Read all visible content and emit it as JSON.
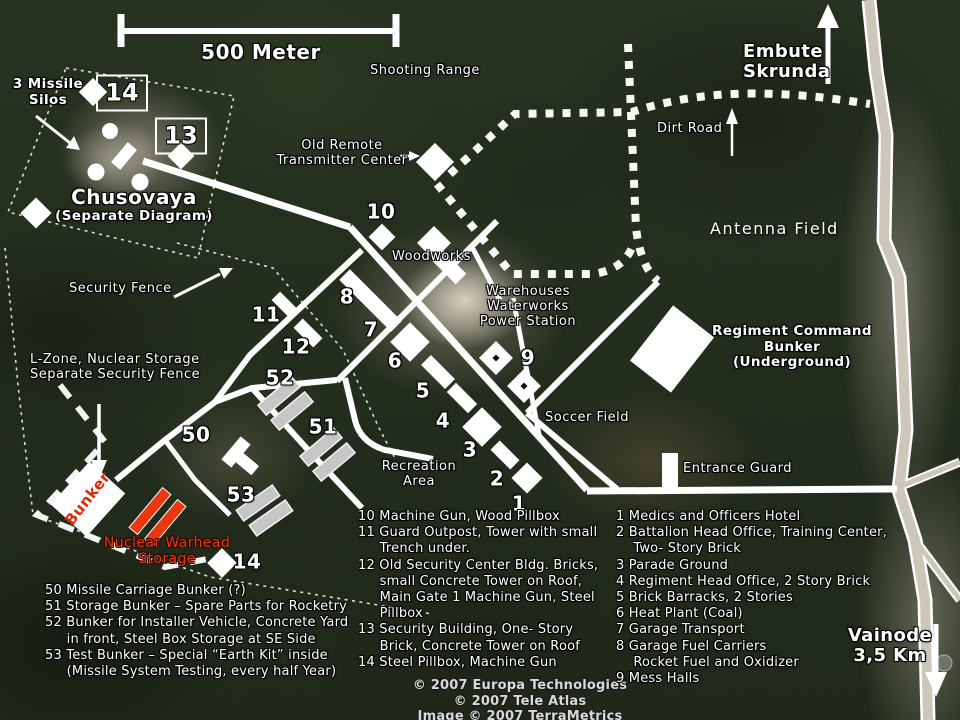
{
  "title": "Annotated satellite map of missile base",
  "colors": {
    "label_text": "#ffffff",
    "warning_text": "#e8380f",
    "road": "#ffffff",
    "highway_fill": "#cdc7b9",
    "bunker_gray": "#c6c6c6",
    "terrain": "#232d1d"
  },
  "scale_bar": {
    "label": "500 Meter"
  },
  "map_labels": [
    {
      "name": "scale-label",
      "text": "500 Meter",
      "x": 261,
      "y": 41,
      "cls": "t-bold20",
      "anchor": "center"
    },
    {
      "name": "label-shooting-range",
      "text": "Shooting Range",
      "x": 370,
      "y": 64,
      "cls": "t-reg",
      "anchor": "left"
    },
    {
      "name": "label-embute-skrunda",
      "text": "Embute\nSkrunda",
      "x": 743,
      "y": 42,
      "cls": "t-bold18",
      "anchor": "left"
    },
    {
      "name": "label-dirt-road",
      "text": "Dirt Road",
      "x": 657,
      "y": 122,
      "cls": "t-reg",
      "anchor": "left"
    },
    {
      "name": "label-antenna-field",
      "text": "Antenna Field",
      "x": 710,
      "y": 220,
      "cls": "t-reg17",
      "anchor": "left"
    },
    {
      "name": "label-old-remote-transmitter",
      "text": "Old Remote\nTransmitter Center",
      "x": 342,
      "y": 139,
      "cls": "t-reg",
      "anchor": "center"
    },
    {
      "name": "label-chusovaya",
      "text": "Chusovaya",
      "x": 134,
      "y": 186,
      "cls": "t-bold20",
      "anchor": "center"
    },
    {
      "name": "label-chusovaya-sub",
      "text": "(Separate Diagram)",
      "x": 134,
      "y": 209,
      "cls": "t-bold14",
      "anchor": "center"
    },
    {
      "name": "label-missile-silos",
      "text": "3 Missile\nSilos",
      "x": 48,
      "y": 77,
      "cls": "t-bold14",
      "anchor": "center"
    },
    {
      "name": "label-security-fence",
      "text": "Security Fence",
      "x": 69,
      "y": 282,
      "cls": "t-reg",
      "anchor": "left"
    },
    {
      "name": "label-l-zone",
      "text": "L-Zone, Nuclear Storage\nSeparate Security Fence",
      "x": 30,
      "y": 353,
      "cls": "t-reg",
      "anchor": "left"
    },
    {
      "name": "label-woodworks",
      "text": "Woodworks",
      "x": 392,
      "y": 250,
      "cls": "t-reg",
      "anchor": "left"
    },
    {
      "name": "label-warehouses",
      "text": "Warehouses\nWaterworks\nPower Station",
      "x": 528,
      "y": 285,
      "cls": "t-reg",
      "anchor": "center"
    },
    {
      "name": "label-regiment-command",
      "text": "Regiment Command\nBunker\n(Underground)",
      "x": 792,
      "y": 324,
      "cls": "t-bold14",
      "anchor": "center"
    },
    {
      "name": "label-soccer-field",
      "text": "Soccer Field",
      "x": 545,
      "y": 411,
      "cls": "t-reg",
      "anchor": "left"
    },
    {
      "name": "label-entrance-guard",
      "text": "Entrance Guard",
      "x": 683,
      "y": 462,
      "cls": "t-reg",
      "anchor": "left"
    },
    {
      "name": "label-recreation-area",
      "text": "Recreation\nArea",
      "x": 419,
      "y": 460,
      "cls": "t-reg",
      "anchor": "center"
    },
    {
      "name": "label-vainode",
      "text": "Vainode\n3,5 Km",
      "x": 890,
      "y": 646,
      "cls": "t-bold19",
      "anchor": "cc"
    },
    {
      "name": "label-nuclear-warhead",
      "text": "Nuclear Warhead\nStorage",
      "x": 167,
      "y": 551,
      "cls": "t-red",
      "anchor": "cc"
    },
    {
      "name": "label-bunker-rotated",
      "text": "Bunker",
      "x": 88,
      "y": 499,
      "cls": "t-redbold",
      "anchor": "cc",
      "rot": -52
    }
  ],
  "map_numbers": [
    {
      "name": "num-10",
      "text": "10",
      "x": 381,
      "y": 212
    },
    {
      "name": "num-8",
      "text": "8",
      "x": 347,
      "y": 297
    },
    {
      "name": "num-7",
      "text": "7",
      "x": 371,
      "y": 330
    },
    {
      "name": "num-6",
      "text": "6",
      "x": 395,
      "y": 361
    },
    {
      "name": "num-5",
      "text": "5",
      "x": 423,
      "y": 391
    },
    {
      "name": "num-4",
      "text": "4",
      "x": 443,
      "y": 421
    },
    {
      "name": "num-3",
      "text": "3",
      "x": 470,
      "y": 450
    },
    {
      "name": "num-2",
      "text": "2",
      "x": 497,
      "y": 479
    },
    {
      "name": "num-1",
      "text": "1",
      "x": 519,
      "y": 504
    },
    {
      "name": "num-11",
      "text": "11",
      "x": 266,
      "y": 315
    },
    {
      "name": "num-12",
      "text": "12",
      "x": 296,
      "y": 347
    },
    {
      "name": "num-52",
      "text": "52",
      "x": 280,
      "y": 378
    },
    {
      "name": "num-51",
      "text": "51",
      "x": 323,
      "y": 427
    },
    {
      "name": "num-50",
      "text": "50",
      "x": 196,
      "y": 435
    },
    {
      "name": "num-53",
      "text": "53",
      "x": 241,
      "y": 495
    },
    {
      "name": "num-9",
      "text": "9",
      "x": 528,
      "y": 358
    },
    {
      "name": "num-14-map",
      "text": "14",
      "x": 247,
      "y": 562
    }
  ],
  "boxed_numbers": [
    {
      "name": "numbox-14",
      "text": "14",
      "x": 122,
      "y": 93
    },
    {
      "name": "numbox-13",
      "text": "13",
      "x": 181,
      "y": 136
    }
  ],
  "legend_columns": [
    {
      "name": "legend-bunkers",
      "x": 45,
      "y": 583,
      "lines": [
        "50 Missile Carriage Bunker (?)",
        "51 Storage Bunker – Spare Parts for Rocketry",
        "52 Bunker for Installer Vehicle, Concrete Yard",
        "     in front, Steel Box Storage at SE Side",
        "53 Test Bunker – Special “Earth Kit” inside",
        "     (Missile System Testing, every half Year)"
      ]
    },
    {
      "name": "legend-defenses",
      "x": 358,
      "y": 509,
      "lines": [
        "10 Machine Gun, Wood Pillbox",
        "11 Guard Outpost, Tower with small",
        "     Trench under.",
        "12 Old Security Center Bldg. Bricks,",
        "     small Concrete Tower on Roof,",
        "     Main Gate 1 Machine Gun, Steel",
        "     Pillbox",
        "13 Security Building, One- Story",
        "     Brick, Concrete Tower on Roof",
        "14 Steel Pillbox, Machine Gun"
      ]
    },
    {
      "name": "legend-buildings",
      "x": 616,
      "y": 509,
      "lines": [
        "1 Medics and Officers Hotel",
        "2 Battalion Head Office, Training Center,",
        "    Two- Story Brick",
        "3 Parade Ground",
        "4 Regiment Head Office, 2 Story Brick",
        "5 Brick Barracks, 2 Stories",
        "6 Heat Plant (Coal)",
        "7 Garage Transport",
        "8 Garage Fuel Carriers",
        "    Rocket Fuel and Oxidizer",
        "9 Mess Halls"
      ]
    }
  ],
  "copyright_lines": [
    "© 2007 Europa Technologies",
    "© 2007 Tele Atlas",
    "Image © 2007 TerraMetrics"
  ]
}
